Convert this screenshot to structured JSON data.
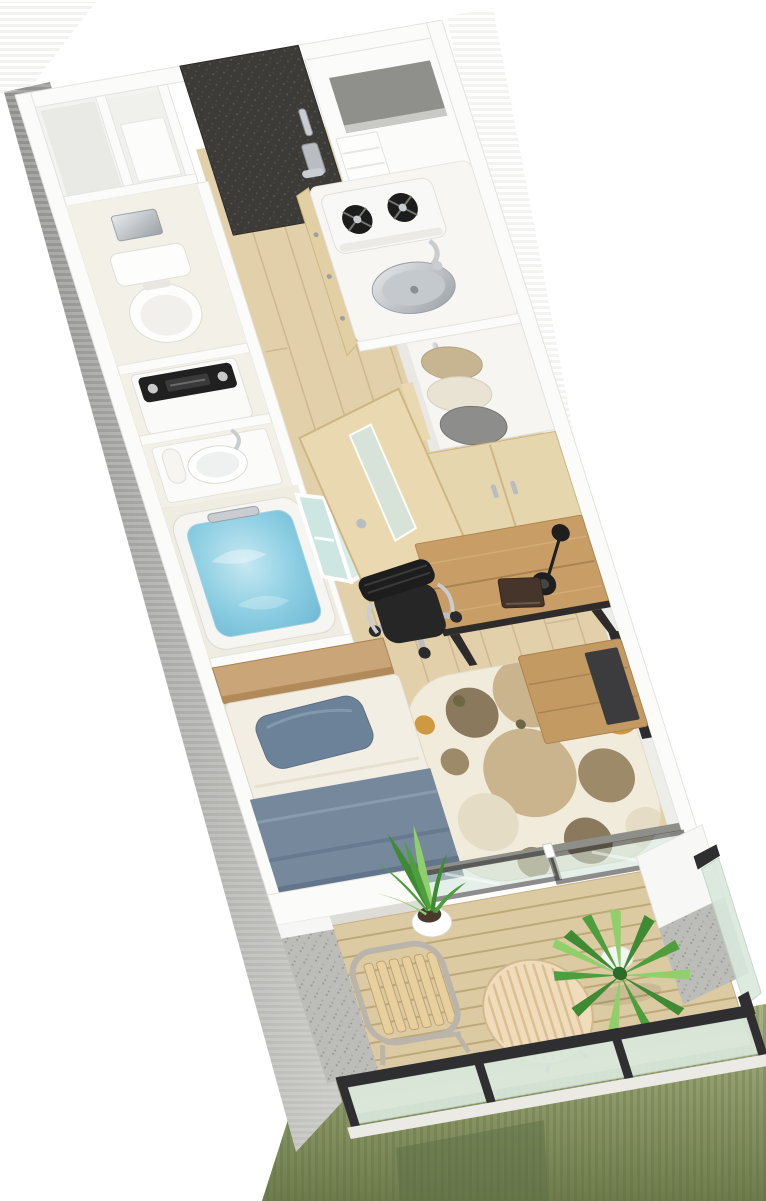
{
  "meta": {
    "title": "3D isometric floor plan render of a studio apartment with balcony",
    "visible_text": "none",
    "view": "axonometric top-down, unit runs diagonally top-left to bottom-right"
  },
  "colors": {
    "background": "#ffffff",
    "wall_white": "#fbfbf9",
    "wall_edge": "#e3e3df",
    "wall_face_shadow": "#ededea",
    "exterior_shadow": "#9a9a98",
    "entrance_door": "#3c3b38",
    "genkan_floor": "#4a4741",
    "wood_floor": "#e2d0ab",
    "plank_line": "#c9b38c",
    "utility_floor": "#f3f0e8",
    "bath_floor": "#efece1",
    "kitchen_counter": "#f7f6f3",
    "cabinet_wood": "#e2cfa3",
    "stove_body": "#f8f8f6",
    "burner_black": "#1c1c1c",
    "washer_body": "#fafaf8",
    "washer_panel": "#202020",
    "toilet_white": "#fdfdfc",
    "tub_shell": "#f6f5f1",
    "folding_door_glass": "#cde6e2",
    "interior_door_wood": "#ead9b0",
    "frosted_glass": "#d6e4dc",
    "closet_door_wood": "#e6d6ae",
    "clothes_beige": "#c7b591",
    "clothes_cream": "#e9e3d4",
    "clothes_gray": "#8d8d8b",
    "headboard_wood": "#caa578",
    "mattress": "#f3eee3",
    "pillow_blue": "#6c8299",
    "blanket_blue": "#75889c",
    "rug_base": "#f1ebdb",
    "rug_tan": "#c9b48e",
    "rug_brown": "#9c8a68",
    "rug_dark": "#8a795c",
    "rug_cream": "#e5dcc6",
    "rug_orange": "#cf9a3f",
    "desk_wood": "#c89e66",
    "desk_frame": "#2e2c2a",
    "chair_black": "#262626",
    "tv_stand_wood": "#c49a63",
    "tv_dark": "#3c3c3e",
    "deck_wood": "#dccaa2",
    "deck_line": "#bda878",
    "rail_frame": "#2f2f31",
    "rail_glass": "#d9e8dc",
    "door_glass": "#cfe2d8",
    "concrete": "#bcbcb8",
    "plant_green": "#3e8b33",
    "plant_mid": "#4f9e3e",
    "plant_light": "#8fd06a",
    "pot_white": "#ffffff",
    "table_wood": "#f0dcba",
    "chair_slat_wood": "#e8cf9e",
    "chrome": "#c9ccd0",
    "niche_gray": "#8f8f8c",
    "outside_green": "#8a976a"
  },
  "scene": {
    "rooms": [
      {
        "name": "entrance",
        "items": [
          "entrance-door",
          "genkan-floor",
          "storage-compartments",
          "wall-niche",
          "pantry-shelf"
        ]
      },
      {
        "name": "kitchen",
        "items": [
          "two-burner-gas-stove",
          "stainless-sink",
          "gooseneck-faucet",
          "wood-cabinet-front"
        ]
      },
      {
        "name": "toilet-room",
        "items": [
          "toilet",
          "wall-cabinet"
        ]
      },
      {
        "name": "laundry",
        "items": [
          "washing-machine"
        ]
      },
      {
        "name": "vanity",
        "items": [
          "washbasin",
          "basin-faucet",
          "towel-roll"
        ]
      },
      {
        "name": "bathroom",
        "items": [
          "bathtub-with-water",
          "bath-faucet",
          "folding-glass-door"
        ]
      },
      {
        "name": "closet",
        "items": [
          "hanging-clothes",
          "chrome-rail",
          "wood-closet-doors"
        ]
      },
      {
        "name": "main-room",
        "items": [
          "single-bed",
          "pillow",
          "blanket",
          "headboard-shelf",
          "wood-desk",
          "desk-lamp",
          "notebook",
          "office-chair",
          "tv-stand",
          "circle-pattern-rug",
          "interior-door",
          "sliding-glass-doors",
          "potted-sansevieria"
        ]
      },
      {
        "name": "balcony",
        "items": [
          "wood-deck",
          "folding-chair",
          "round-slat-table",
          "yucca-plant",
          "frosted-glass-railing",
          "concrete-walls"
        ]
      }
    ]
  }
}
